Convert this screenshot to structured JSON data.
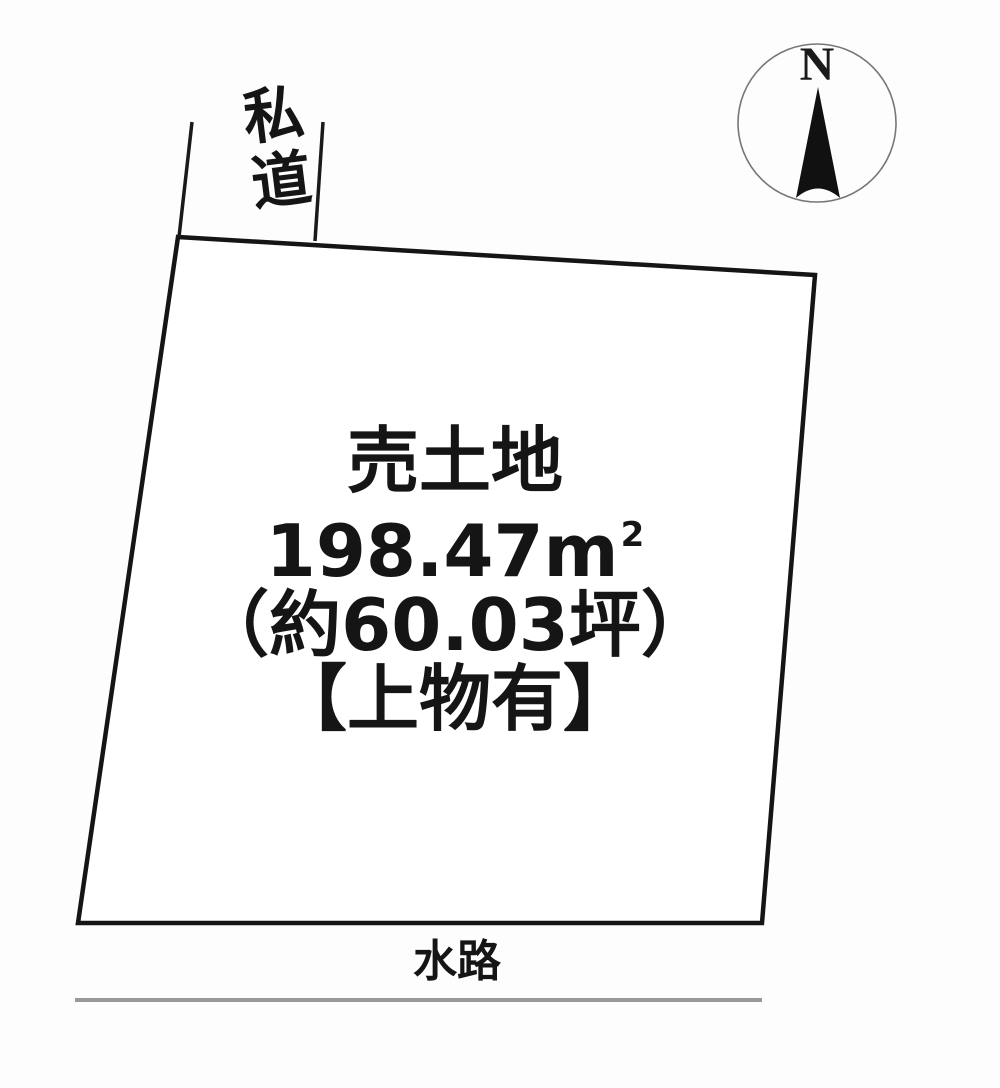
{
  "diagram": {
    "road_label": "私道",
    "parcel": {
      "title": "売土地",
      "area_m2": "198.47m",
      "area_m2_sup": "2",
      "area_tsubo": "（約60.03坪）",
      "note": "【上物有】"
    },
    "compass": {
      "north_label": "N"
    },
    "waterway_label": "水路",
    "colors": {
      "boundary_line": "#151515",
      "road_line": "#1a1a1a",
      "compass_circle": "#777777",
      "compass_needle": "#111111",
      "waterway_line": "#999999",
      "background": "#fdfdfd"
    }
  }
}
